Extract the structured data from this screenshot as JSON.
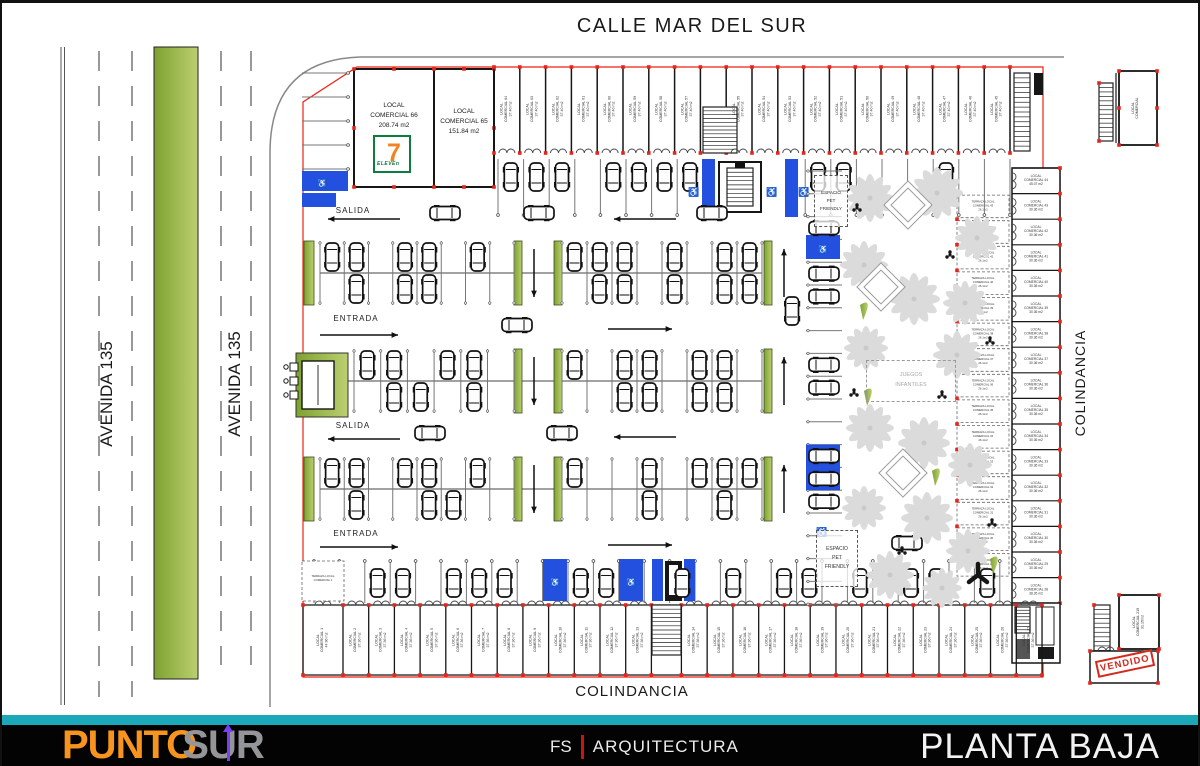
{
  "streets": {
    "top": "CALLE MAR DEL SUR",
    "avenida": "AVENIDA 135",
    "colindancia_right": "COLINDANCIA",
    "colindancia_bottom": "COLINDANCIA"
  },
  "labels": {
    "salida": "SALIDA",
    "entrada": "ENTRADA",
    "pet1": "ESPACIO",
    "pet2": "PET",
    "pet3": "FRIENDLY",
    "kids1": "JUEGOS",
    "kids2": "INFANTILES",
    "vendido": "VENDIDO"
  },
  "icons": {
    "handicap": "♿"
  },
  "colors": {
    "accent_red": "#ee2213",
    "blue": "#2450e0",
    "teal": "#1ba8b8",
    "orange": "#f7941e",
    "gray_logo": "#939598",
    "olive": "#8aa53f",
    "purple_pin": "#7a3ff0"
  },
  "footer": {
    "logo_punto": "PUNTO",
    "logo_sur": "SUR",
    "fs": "FS",
    "arquitectura": "ARQUITECTURA",
    "sheet_title": "PLANTA BAJA"
  },
  "plan": {
    "local66": {
      "l1": "LOCAL",
      "l2": "COMERCIAL 66",
      "area": "208.74 m2"
    },
    "local65": {
      "l1": "LOCAL",
      "l2": "COMERCIAL 65",
      "area": "151.84 m2"
    },
    "seven": {
      "digit": "7",
      "word": "ELEVEn"
    },
    "terraza1": {
      "l1": "TERRAZA LOCAL",
      "l2": "COMERCIAL 1",
      "l3": ""
    },
    "frag_top": {
      "l1": "LOCAL",
      "l2": "COMERCIAL",
      "l3": ""
    },
    "frag_bottom": {
      "l1": "LOCAL",
      "l2": "COMERCIAL 219",
      "l3": "31.15m2"
    },
    "top_row": [
      {
        "l1": "LOCAL",
        "l2": "COMERCIAL 64",
        "l3": "37.40 m2"
      },
      {
        "l1": "LOCAL",
        "l2": "COMERCIAL 63",
        "l3": "37.40 m2"
      },
      {
        "l1": "LOCAL",
        "l2": "COMERCIAL 62",
        "l3": "37.40 m2"
      },
      {
        "l1": "LOCAL",
        "l2": "COMERCIAL 61",
        "l3": "37.40 m2"
      },
      {
        "l1": "LOCAL",
        "l2": "COMERCIAL 60",
        "l3": "37.40 m2"
      },
      {
        "l1": "LOCAL",
        "l2": "COMERCIAL 59",
        "l3": "37.40 m2"
      },
      {
        "l1": "LOCAL",
        "l2": "COMERCIAL 58",
        "l3": "37.40 m2"
      },
      {
        "l1": "LOCAL",
        "l2": "COMERCIAL 57",
        "l3": "37.40 m2"
      },
      {
        "l1": "LOCAL",
        "l2": "COMERCIAL 56",
        "l3": "37.40 m2"
      },
      {
        "l1": "LOCAL",
        "l2": "COMERCIAL 55",
        "l3": "37.40 m2"
      },
      {
        "l1": "LOCAL",
        "l2": "COMERCIAL 54",
        "l3": "37.40 m2"
      },
      {
        "l1": "LOCAL",
        "l2": "COMERCIAL 53",
        "l3": "37.40 m2"
      },
      {
        "l1": "LOCAL",
        "l2": "COMERCIAL 52",
        "l3": "37.40 m2"
      },
      {
        "l1": "LOCAL",
        "l2": "COMERCIAL 51",
        "l3": "37.40 m2"
      },
      {
        "l1": "LOCAL",
        "l2": "COMERCIAL 50",
        "l3": "37.40 m2"
      },
      {
        "l1": "LOCAL",
        "l2": "COMERCIAL 49",
        "l3": "37.40 m2"
      },
      {
        "l1": "LOCAL",
        "l2": "COMERCIAL 48",
        "l3": "37.40 m2"
      },
      {
        "l1": "LOCAL",
        "l2": "COMERCIAL 47",
        "l3": "37.40 m2"
      },
      {
        "l1": "LOCAL",
        "l2": "COMERCIAL 46",
        "l3": "37.40 m2"
      },
      {
        "l1": "LOCAL",
        "l2": "COMERCIAL 45",
        "l3": "37.40 m2"
      }
    ],
    "right_col": [
      {
        "l1": "LOCAL",
        "l2": "COMERCIAL 44",
        "l3": "45.07 m2"
      },
      {
        "l1": "LOCAL",
        "l2": "COMERCIAL 43",
        "l3": "30.36 m2"
      },
      {
        "l1": "LOCAL",
        "l2": "COMERCIAL 42",
        "l3": "30.36 m2"
      },
      {
        "l1": "LOCAL",
        "l2": "COMERCIAL 41",
        "l3": "30.36 m2"
      },
      {
        "l1": "LOCAL",
        "l2": "COMERCIAL 40",
        "l3": "30.36 m2"
      },
      {
        "l1": "LOCAL",
        "l2": "COMERCIAL 39",
        "l3": "30.36 m2"
      },
      {
        "l1": "LOCAL",
        "l2": "COMERCIAL 38",
        "l3": "30.36 m2"
      },
      {
        "l1": "LOCAL",
        "l2": "COMERCIAL 37",
        "l3": "30.36 m2"
      },
      {
        "l1": "LOCAL",
        "l2": "COMERCIAL 36",
        "l3": "30.36 m2"
      },
      {
        "l1": "LOCAL",
        "l2": "COMERCIAL 35",
        "l3": "30.36 m2"
      },
      {
        "l1": "LOCAL",
        "l2": "COMERCIAL 34",
        "l3": "30.36 m2"
      },
      {
        "l1": "LOCAL",
        "l2": "COMERCIAL 33",
        "l3": "30.36 m2"
      },
      {
        "l1": "LOCAL",
        "l2": "COMERCIAL 32",
        "l3": "30.36 m2"
      },
      {
        "l1": "LOCAL",
        "l2": "COMERCIAL 31",
        "l3": "30.36 m2"
      },
      {
        "l1": "LOCAL",
        "l2": "COMERCIAL 30",
        "l3": "30.36 m2"
      },
      {
        "l1": "LOCAL",
        "l2": "COMERCIAL 29",
        "l3": "30.36 m2"
      },
      {
        "l1": "LOCAL",
        "l2": "COMERCIAL 28",
        "l3": "38.26 m2"
      }
    ],
    "terrazas": [
      {
        "l1": "TERRAZA LOCAL",
        "l2": "COMERCIAL 43",
        "l3": "26.1m2"
      },
      {
        "l1": "TERRAZA LOCAL",
        "l2": "COMERCIAL 42",
        "l3": "26.1m2"
      },
      {
        "l1": "TERRAZA LOCAL",
        "l2": "COMERCIAL 41",
        "l3": "26.1m2"
      },
      {
        "l1": "TERRAZA LOCAL",
        "l2": "COMERCIAL 40",
        "l3": "26.1m2"
      },
      {
        "l1": "TERRAZA LOCAL",
        "l2": "COMERCIAL 39",
        "l3": "26.1m2"
      },
      {
        "l1": "TERRAZA LOCAL",
        "l2": "COMERCIAL 38",
        "l3": "26.1m2"
      },
      {
        "l1": "TERRAZA LOCAL",
        "l2": "COMERCIAL 37",
        "l3": "26.1m2"
      },
      {
        "l1": "TERRAZA LOCAL",
        "l2": "COMERCIAL 36",
        "l3": "26.1m2"
      },
      {
        "l1": "TERRAZA LOCAL",
        "l2": "COMERCIAL 35",
        "l3": "26.1m2"
      },
      {
        "l1": "TERRAZA LOCAL",
        "l2": "COMERCIAL 34",
        "l3": "26.1m2"
      },
      {
        "l1": "TERRAZA LOCAL",
        "l2": "COMERCIAL 33",
        "l3": "26.1m2"
      },
      {
        "l1": "TERRAZA LOCAL",
        "l2": "COMERCIAL 32",
        "l3": "26.1m2"
      },
      {
        "l1": "TERRAZA LOCAL",
        "l2": "COMERCIAL 31",
        "l3": "26.1m2"
      },
      {
        "l1": "TERRAZA LOCAL",
        "l2": "COMERCIAL 30",
        "l3": "26.1m2"
      },
      {
        "l1": "TERRAZA LOCAL",
        "l2": "COMERCIAL 29",
        "l3": "26.1m2"
      }
    ],
    "bottom_row": [
      {
        "l1": "LOCAL",
        "l2": "COMERCIAL 1",
        "l3": "44.96 m2"
      },
      {
        "l1": "LOCAL",
        "l2": "COMERCIAL 2",
        "l3": "37.36 m2"
      },
      {
        "l1": "LOCAL",
        "l2": "COMERCIAL 3",
        "l3": "37.36 m2"
      },
      {
        "l1": "LOCAL",
        "l2": "COMERCIAL 4",
        "l3": "37.36 m2"
      },
      {
        "l1": "LOCAL",
        "l2": "COMERCIAL 5",
        "l3": "37.36 m2"
      },
      {
        "l1": "LOCAL",
        "l2": "COMERCIAL 6",
        "l3": "37.36 m2"
      },
      {
        "l1": "LOCAL",
        "l2": "COMERCIAL 7",
        "l3": "37.36 m2"
      },
      {
        "l1": "LOCAL",
        "l2": "COMERCIAL 8",
        "l3": "37.36 m2"
      },
      {
        "l1": "LOCAL",
        "l2": "COMERCIAL 9",
        "l3": "37.36 m2"
      },
      {
        "l1": "LOCAL",
        "l2": "COMERCIAL 10",
        "l3": "37.36 m2"
      },
      {
        "l1": "LOCAL",
        "l2": "COMERCIAL 11",
        "l3": "37.36 m2"
      },
      {
        "l1": "LOCAL",
        "l2": "COMERCIAL 12",
        "l3": "37.36 m2"
      },
      {
        "l1": "LOCAL",
        "l2": "COMERCIAL 13",
        "l3": "37.36 m2"
      },
      {
        "l1": "LOCAL",
        "l2": "COMERCIAL 14",
        "l3": "37.36 m2"
      },
      {
        "l1": "LOCAL",
        "l2": "COMERCIAL 15",
        "l3": "37.36 m2"
      },
      {
        "l1": "LOCAL",
        "l2": "COMERCIAL 16",
        "l3": "37.36 m2"
      },
      {
        "l1": "LOCAL",
        "l2": "COMERCIAL 17",
        "l3": "37.36 m2"
      },
      {
        "l1": "LOCAL",
        "l2": "COMERCIAL 18",
        "l3": "37.36 m2"
      },
      {
        "l1": "LOCAL",
        "l2": "COMERCIAL 19",
        "l3": "37.36 m2"
      },
      {
        "l1": "LOCAL",
        "l2": "COMERCIAL 20",
        "l3": "37.36 m2"
      },
      {
        "l1": "LOCAL",
        "l2": "COMERCIAL 21",
        "l3": "37.36 m2"
      },
      {
        "l1": "LOCAL",
        "l2": "COMERCIAL 22",
        "l3": "37.36 m2"
      },
      {
        "l1": "LOCAL",
        "l2": "COMERCIAL 23",
        "l3": "37.36 m2"
      },
      {
        "l1": "LOCAL",
        "l2": "COMERCIAL 24",
        "l3": "37.36 m2"
      },
      {
        "l1": "LOCAL",
        "l2": "COMERCIAL 25",
        "l3": "37.36 m2"
      },
      {
        "l1": "LOCAL",
        "l2": "COMERCIAL 26",
        "l3": "37.36 m2"
      },
      {
        "l1": "LOCAL",
        "l2": "COMERCIAL 27",
        "l3": "37.36 m2"
      }
    ]
  }
}
